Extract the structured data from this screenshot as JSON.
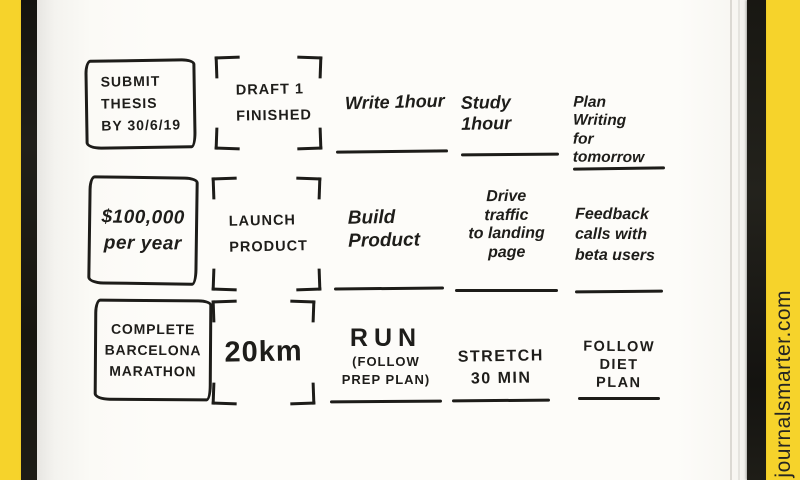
{
  "watermark": "journalsmarter.com",
  "colors": {
    "frame_yellow": "#F6D32B",
    "cover_black": "#1B1A15",
    "paper_white": "#FDFCF9",
    "ink": "#1E1D1A"
  },
  "rows": [
    {
      "goal": "SUBMIT\nTHESIS\nBY 30/6/19",
      "milestone": "DRAFT 1\nFINISHED",
      "tasks": [
        {
          "text": "Write 1hour"
        },
        {
          "text": "Study 1hour"
        },
        {
          "text": "Plan\nWriting\nfor tomorrow"
        }
      ]
    },
    {
      "goal": "$100,000\nper year",
      "milestone": "LAUNCH\nPRODUCT",
      "tasks": [
        {
          "text": "Build\nProduct"
        },
        {
          "text": "Drive\ntraffic\nto landing\npage"
        },
        {
          "text": "Feedback\ncalls with\nbeta users"
        }
      ]
    },
    {
      "goal": "COMPLETE\nBARCELONA\nMARATHON",
      "milestone": "20km",
      "tasks": [
        {
          "text": "RUN",
          "note": "(FOLLOW\nPREP PLAN)"
        },
        {
          "text": "STRETCH\n30 MIN"
        },
        {
          "text": "FOLLOW\nDIET\nPLAN"
        }
      ]
    }
  ]
}
